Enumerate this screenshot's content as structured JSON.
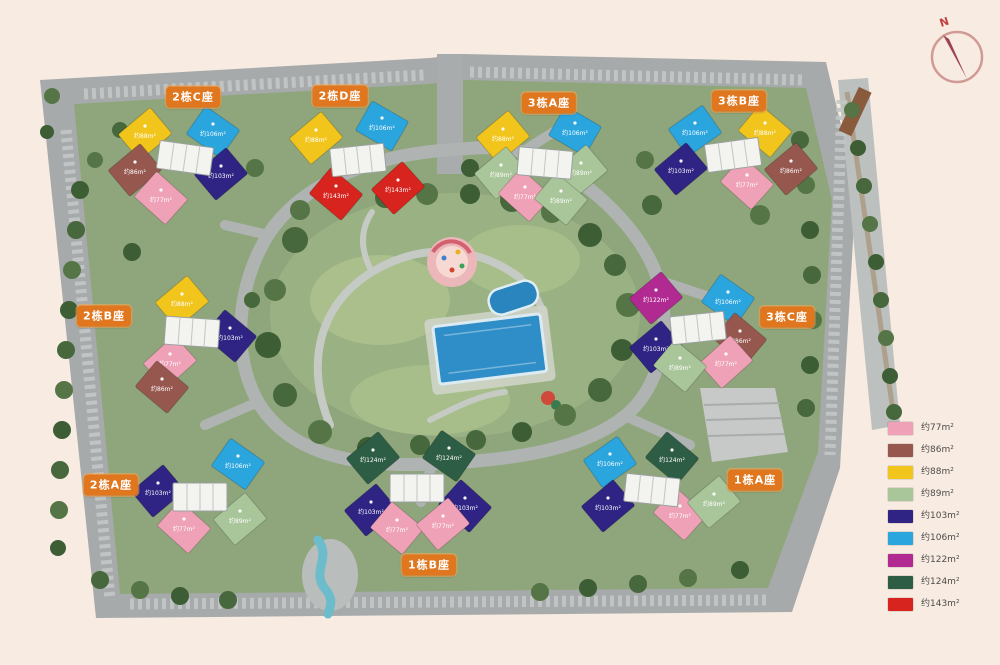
{
  "compass": {
    "label": "N"
  },
  "legend": {
    "items": [
      {
        "key": "pink",
        "color": "#efa2b7",
        "label": "约77m²"
      },
      {
        "key": "brown",
        "color": "#96584e",
        "label": "约86m²"
      },
      {
        "key": "yellow",
        "color": "#f2c51d",
        "label": "约88m²"
      },
      {
        "key": "sage",
        "color": "#a9c69a",
        "label": "约89m²"
      },
      {
        "key": "navy",
        "color": "#2f2383",
        "label": "约103m²"
      },
      {
        "key": "lightblue",
        "color": "#2ba5de",
        "label": "约106m²"
      },
      {
        "key": "magenta",
        "color": "#b02a91",
        "label": "约122m²"
      },
      {
        "key": "darkgreen",
        "color": "#2d5d44",
        "label": "约124m²"
      },
      {
        "key": "red",
        "color": "#d8241e",
        "label": "约143m²"
      }
    ]
  },
  "plan": {
    "label_color": "#e0771f",
    "labels": [
      {
        "text": "2栋C座",
        "x": 193,
        "y": 97
      },
      {
        "text": "2栋D座",
        "x": 340,
        "y": 96
      },
      {
        "text": "3栋A座",
        "x": 549,
        "y": 103
      },
      {
        "text": "3栋B座",
        "x": 739,
        "y": 101
      },
      {
        "text": "2栋B座",
        "x": 104,
        "y": 316
      },
      {
        "text": "3栋C座",
        "x": 787,
        "y": 317
      },
      {
        "text": "2栋A座",
        "x": 111,
        "y": 485
      },
      {
        "text": "1栋A座",
        "x": 755,
        "y": 480
      },
      {
        "text": "1栋B座",
        "x": 429,
        "y": 565
      }
    ],
    "clusters": [
      {
        "name": "2栋C座",
        "x": 185,
        "y": 158,
        "frot": 8,
        "units": [
          {
            "key": "yellow",
            "dx": -40,
            "dy": -24,
            "rot": -40
          },
          {
            "key": "lightblue",
            "dx": 28,
            "dy": -26,
            "rot": 35
          },
          {
            "key": "brown",
            "dx": -50,
            "dy": 12,
            "rot": -40
          },
          {
            "key": "pink",
            "dx": -24,
            "dy": 40,
            "rot": 42
          },
          {
            "key": "navy",
            "dx": 36,
            "dy": 16,
            "rot": -40
          }
        ]
      },
      {
        "name": "2栋D座",
        "x": 358,
        "y": 160,
        "frot": -6,
        "units": [
          {
            "key": "yellow",
            "dx": -42,
            "dy": -22,
            "rot": -40
          },
          {
            "key": "lightblue",
            "dx": 24,
            "dy": -34,
            "rot": 30
          },
          {
            "key": "red",
            "dx": -22,
            "dy": 34,
            "rot": 40
          },
          {
            "key": "red",
            "dx": 40,
            "dy": 28,
            "rot": -42
          }
        ]
      },
      {
        "name": "3栋A座",
        "x": 545,
        "y": 163,
        "frot": 5,
        "units": [
          {
            "key": "yellow",
            "dx": -42,
            "dy": -26,
            "rot": -40
          },
          {
            "key": "lightblue",
            "dx": 30,
            "dy": -32,
            "rot": 30
          },
          {
            "key": "sage",
            "dx": -44,
            "dy": 10,
            "rot": -40
          },
          {
            "key": "pink",
            "dx": -20,
            "dy": 32,
            "rot": 42
          },
          {
            "key": "sage",
            "dx": 36,
            "dy": 8,
            "rot": -40
          },
          {
            "key": "sage",
            "dx": 16,
            "dy": 36,
            "rot": 40
          }
        ]
      },
      {
        "name": "3栋B座",
        "x": 733,
        "y": 155,
        "frot": -8,
        "units": [
          {
            "key": "lightblue",
            "dx": -38,
            "dy": -24,
            "rot": -35
          },
          {
            "key": "yellow",
            "dx": 32,
            "dy": -24,
            "rot": 40
          },
          {
            "key": "navy",
            "dx": -52,
            "dy": 14,
            "rot": -40
          },
          {
            "key": "pink",
            "dx": 14,
            "dy": 28,
            "rot": 42
          },
          {
            "key": "brown",
            "dx": 58,
            "dy": 14,
            "rot": -40
          }
        ]
      },
      {
        "name": "2栋B座",
        "x": 192,
        "y": 332,
        "frot": 4,
        "units": [
          {
            "key": "yellow",
            "dx": -10,
            "dy": -30,
            "rot": -40
          },
          {
            "key": "navy",
            "dx": 38,
            "dy": 4,
            "rot": 40
          },
          {
            "key": "pink",
            "dx": -22,
            "dy": 30,
            "rot": -42
          },
          {
            "key": "brown",
            "dx": -30,
            "dy": 55,
            "rot": 40
          }
        ]
      },
      {
        "name": "3栋C座",
        "x": 698,
        "y": 328,
        "frot": -6,
        "units": [
          {
            "key": "magenta",
            "dx": -42,
            "dy": -30,
            "rot": -40
          },
          {
            "key": "lightblue",
            "dx": 30,
            "dy": -28,
            "rot": 35
          },
          {
            "key": "navy",
            "dx": -42,
            "dy": 19,
            "rot": -40
          },
          {
            "key": "brown",
            "dx": 42,
            "dy": 11,
            "rot": 40
          },
          {
            "key": "pink",
            "dx": 28,
            "dy": 34,
            "rot": -42
          },
          {
            "key": "sage",
            "dx": -18,
            "dy": 38,
            "rot": 40
          }
        ]
      },
      {
        "name": "2栋A座",
        "x": 200,
        "y": 497,
        "frot": 0,
        "units": [
          {
            "key": "lightblue",
            "dx": 38,
            "dy": -33,
            "rot": 35
          },
          {
            "key": "navy",
            "dx": -42,
            "dy": -6,
            "rot": -40
          },
          {
            "key": "pink",
            "dx": -16,
            "dy": 30,
            "rot": 42
          },
          {
            "key": "sage",
            "dx": 40,
            "dy": 22,
            "rot": -40
          }
        ]
      },
      {
        "name": "1栋B座",
        "x": 417,
        "y": 488,
        "frot": 0,
        "units": [
          {
            "key": "darkgreen",
            "dx": -44,
            "dy": -30,
            "rot": -40
          },
          {
            "key": "darkgreen",
            "dx": 32,
            "dy": -32,
            "rot": 35
          },
          {
            "key": "navy",
            "dx": -46,
            "dy": 22,
            "rot": -40
          },
          {
            "key": "navy",
            "dx": 48,
            "dy": 18,
            "rot": 42
          },
          {
            "key": "pink",
            "dx": -20,
            "dy": 40,
            "rot": 40
          },
          {
            "key": "pink",
            "dx": 26,
            "dy": 36,
            "rot": -40
          }
        ]
      },
      {
        "name": "1栋A座",
        "x": 652,
        "y": 490,
        "frot": 6,
        "units": [
          {
            "key": "lightblue",
            "dx": -42,
            "dy": -28,
            "rot": -35
          },
          {
            "key": "darkgreen",
            "dx": 20,
            "dy": -32,
            "rot": 40
          },
          {
            "key": "navy",
            "dx": -44,
            "dy": 16,
            "rot": -40
          },
          {
            "key": "pink",
            "dx": 28,
            "dy": 24,
            "rot": 42
          },
          {
            "key": "sage",
            "dx": 62,
            "dy": 12,
            "rot": -40
          }
        ]
      }
    ]
  }
}
